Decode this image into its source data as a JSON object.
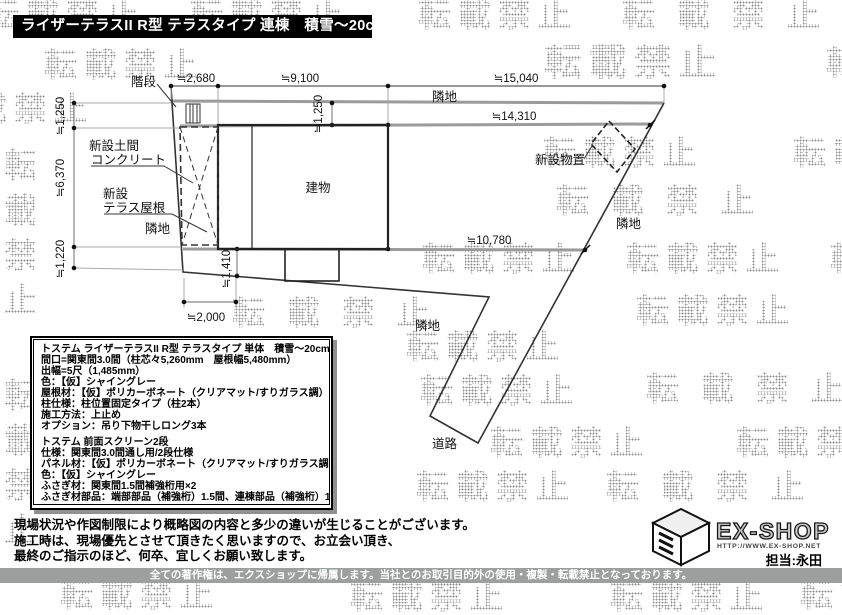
{
  "title": "ライザーテラスII R型 テラスタイプ 連棟　積雪～20cm対応",
  "watermark": {
    "text": "転載禁止"
  },
  "plan": {
    "labels": {
      "stairs": "階段",
      "neighbor": "隣地",
      "road": "道路",
      "building": "建物",
      "shed": "新設物置",
      "doma_line1": "新設土間",
      "doma_line2": "コンクリート",
      "terrace_line1": "新設",
      "terrace_line2": "テラス屋根"
    },
    "dimensions": {
      "top_seg1": "≒2,680",
      "top_seg2": "≒9,100",
      "top_seg3": "≒15,040",
      "fence_upper": "≒14,310",
      "fence_lower": "≒10,780",
      "offset_building_top": "≒1,250",
      "left_seg1": "≒1,250",
      "left_seg2": "≒6,370",
      "left_seg3": "≒1,220",
      "offset_building_bottom": "≒1,410",
      "terrace_width": "≒2,000"
    }
  },
  "spec_box": {
    "section1": [
      "トステム ライザーテラスII R型 テラスタイプ 単体　積雪～20cm対応",
      "間口=関東間3.0間（柱芯々5,260mm　屋根幅5,480mm）",
      "出幅=5尺（1,485mm）",
      "色：【仮】シャイングレー",
      "屋根材：【仮】ポリカーボネート（クリアマット/すりガラス調）",
      "柱仕様：柱位置固定タイプ（柱2本）",
      "施工方法：上止め",
      "オプション：吊り下物干しロング3本"
    ],
    "section2": [
      "トステム 前面スクリーン2段",
      "仕様：関東間3.0間通し用/2段仕様",
      "パネル材：【仮】ポリカーボネート（クリアマット/すりガラス調）",
      "色：【仮】シャイングレー",
      "ふさぎ材：関東間1.5間補強桁用×2",
      "ふさぎ材部品：端部部品（補強桁）1.5間、連棟部品（補強桁）1.5間用"
    ]
  },
  "notes": [
    "現場状況や作図制限により概略図の内容と多少の違いが生じることがございます。",
    "施工時は、現場優先とさせて頂きたく思いますので、お立会い頂き、",
    "最終のご指示のほど、何卒、宜しくお願い致します。"
  ],
  "footer": {
    "copyright": "全ての著作権は、エクスショップに帰属します。当社とのお取引目的外の使用・複製・転載禁止となっております。"
  },
  "logo": {
    "brand": "EX-SHOP",
    "url": "HTTP://WWW.EX-SHOP.NET",
    "agent": "担当:永田"
  }
}
